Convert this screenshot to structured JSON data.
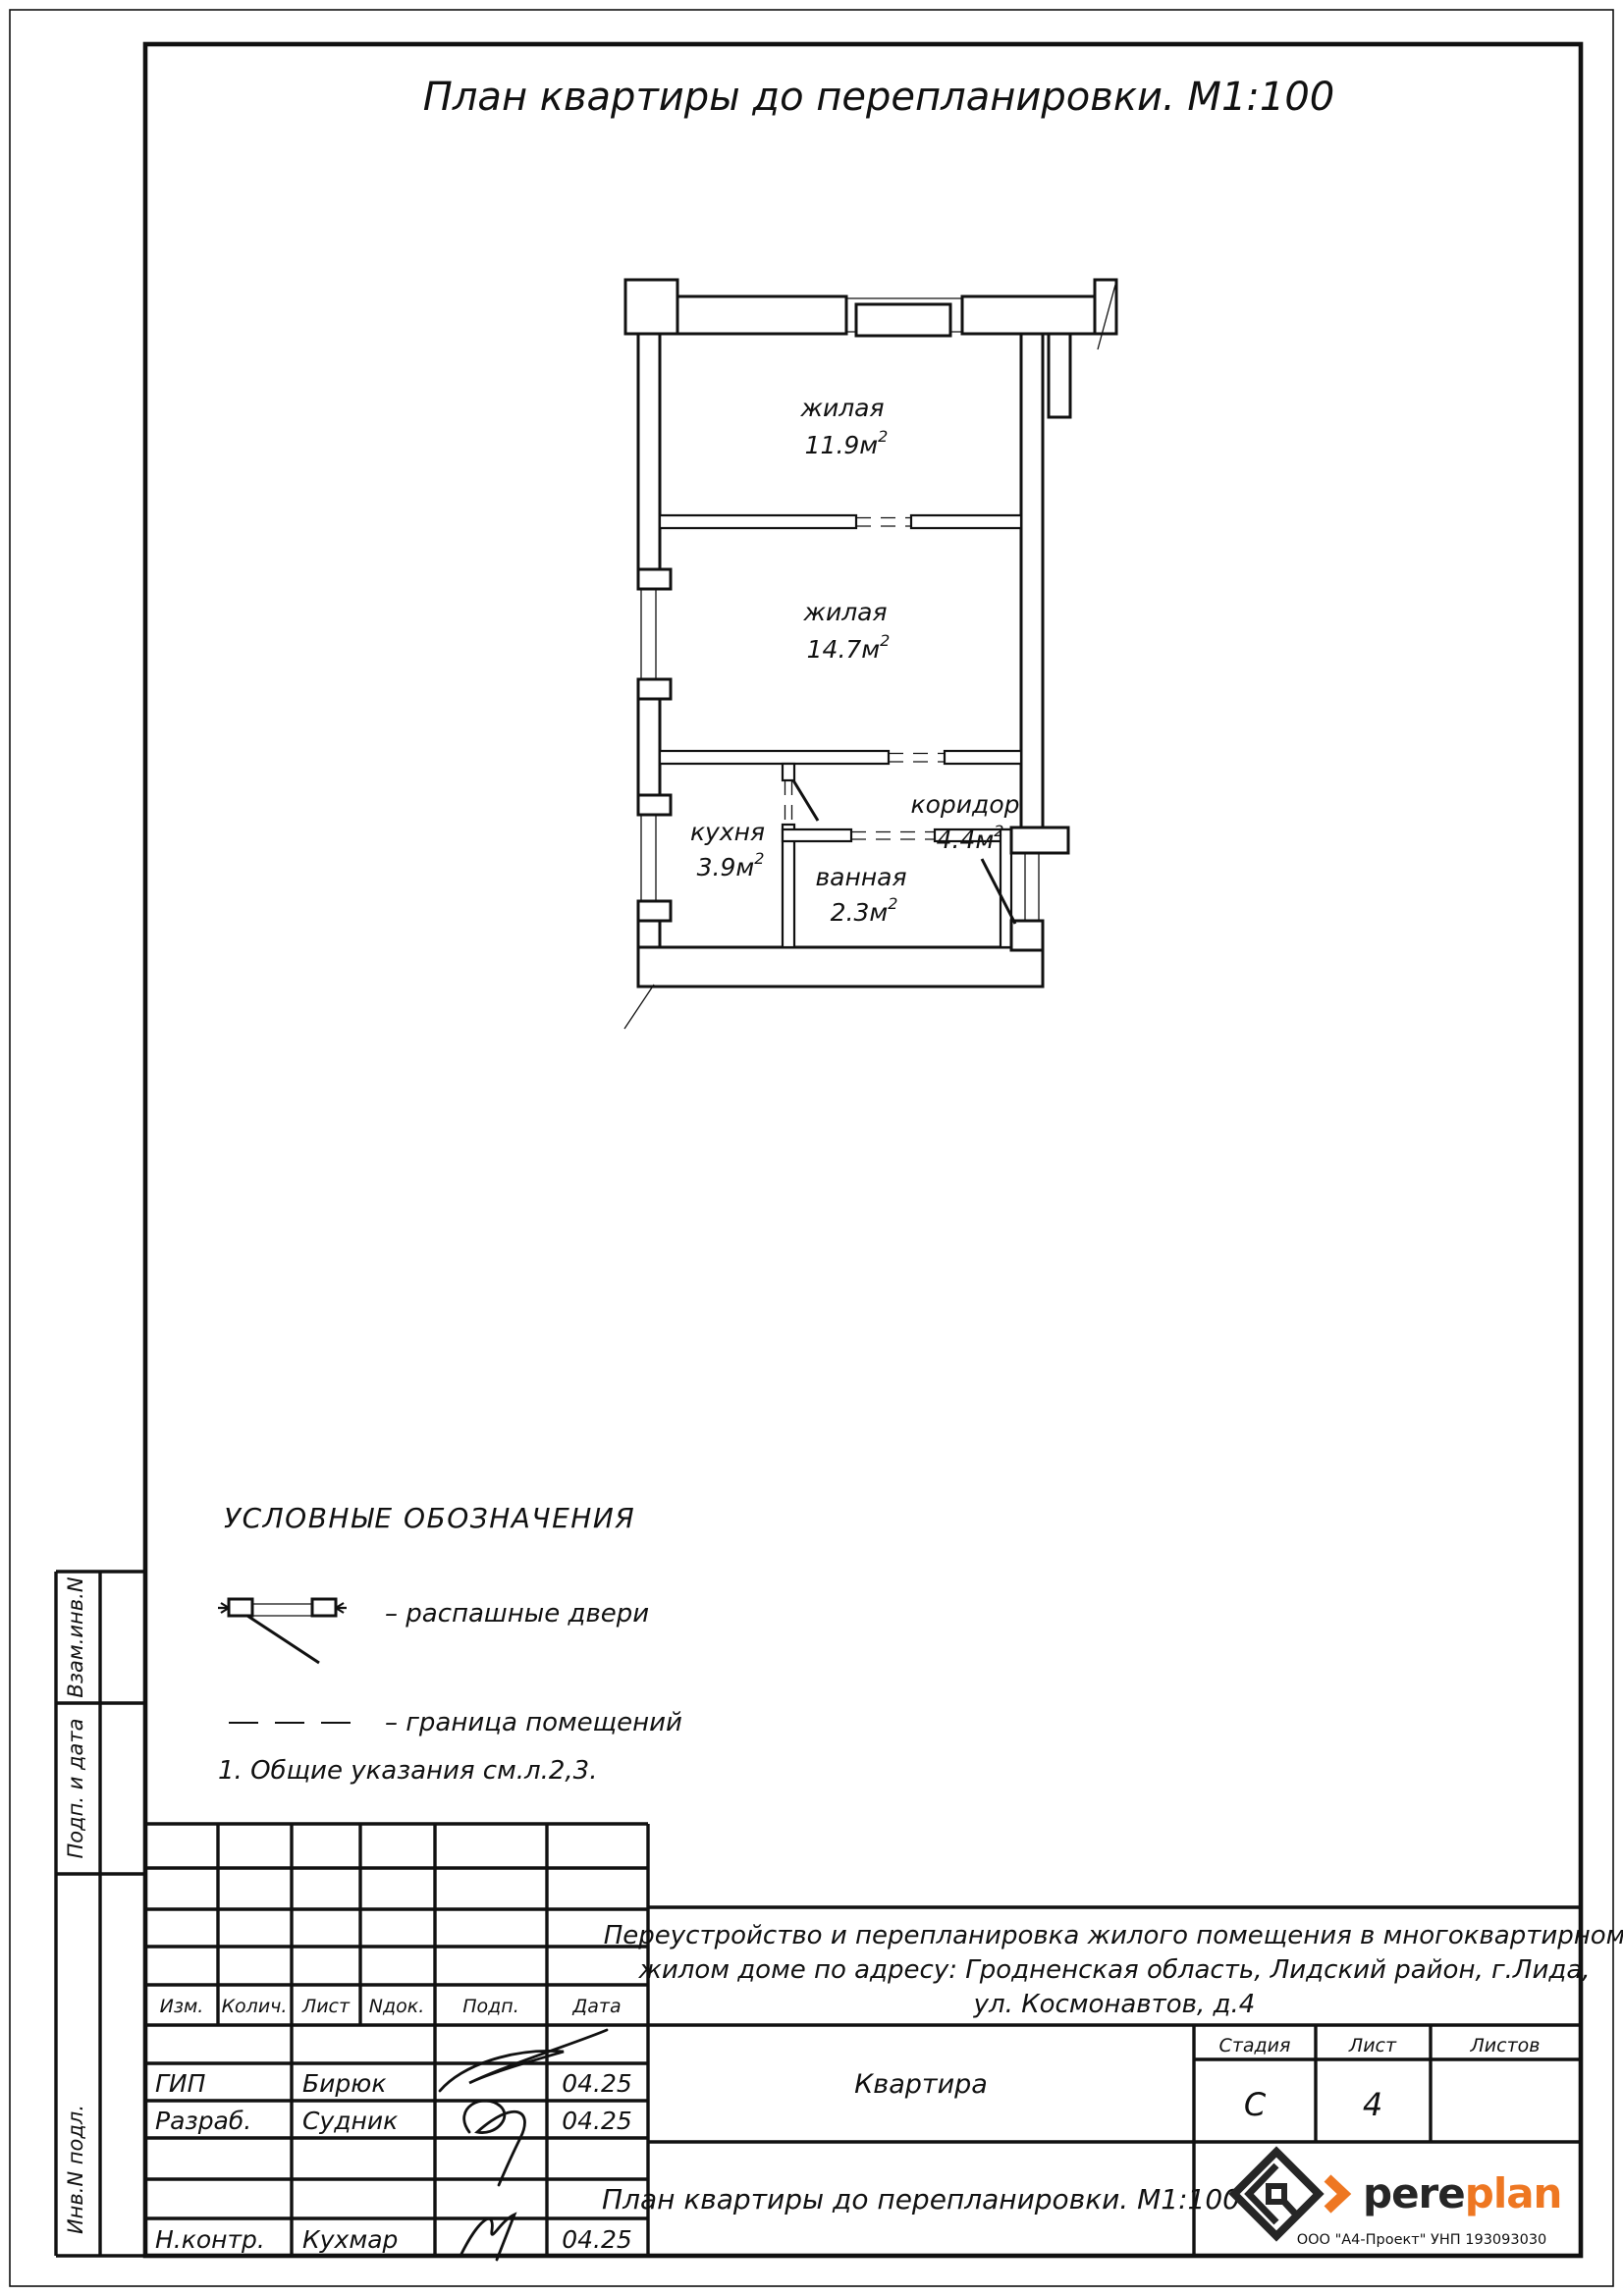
{
  "page_title": "План квартиры до перепланировки. М1:100",
  "floor_plan": {
    "rooms": [
      {
        "name": "жилая",
        "area": "11.9м",
        "sup": "2"
      },
      {
        "name": "жилая",
        "area": "14.7м",
        "sup": "2"
      },
      {
        "name": "кухня",
        "area": "3.9м",
        "sup": "2"
      },
      {
        "name": "ванная",
        "area": "2.3м",
        "sup": "2"
      },
      {
        "name": "коридор",
        "area": "4.4м",
        "sup": "2"
      }
    ]
  },
  "legend": {
    "title": "УСЛОВНЫЕ ОБОЗНАЧЕНИЯ",
    "items": [
      {
        "icon": "swing-doors-symbol",
        "label": "– распашные двери"
      },
      {
        "icon": "room-boundary-symbol",
        "label": "– граница помещений"
      }
    ]
  },
  "note": "1. Общие указания см.л.2,3.",
  "side_strip": {
    "labels": [
      "Взам.инв.N",
      "Подп. и дата",
      "Инв.N подл."
    ]
  },
  "title_block": {
    "revision_headers": [
      "Изм.",
      "Колич.",
      "Лист",
      "Nдок.",
      "Подп.",
      "Дата"
    ],
    "rows": [
      {
        "role": "ГИП",
        "name": "Бирюк",
        "date": "04.25"
      },
      {
        "role": "Разраб.",
        "name": "Судник",
        "date": "04.25"
      },
      {
        "role": "Н.контр.",
        "name": "Кухмар",
        "date": "04.25"
      }
    ],
    "description_lines": [
      "Переустройство и перепланировка жилого помещения в многоквартирном",
      "жилом доме по адресу: Гродненская область, Лидский район, г.Лида,",
      "ул. Космонавтов, д.4"
    ],
    "object_name": "Квартира",
    "stage": {
      "label": "Стадия",
      "value": "С"
    },
    "sheet": {
      "label": "Лист",
      "value": "4"
    },
    "sheets": {
      "label": "Листов",
      "value": ""
    },
    "drawing_title": "План квартиры до перепланировки. М1:100",
    "logo": {
      "brand_black": "pere",
      "brand_orange": "plan",
      "orange_color": "#EE7722",
      "footer": "ООО \"А4-Проект\" УНП 193093030"
    }
  }
}
